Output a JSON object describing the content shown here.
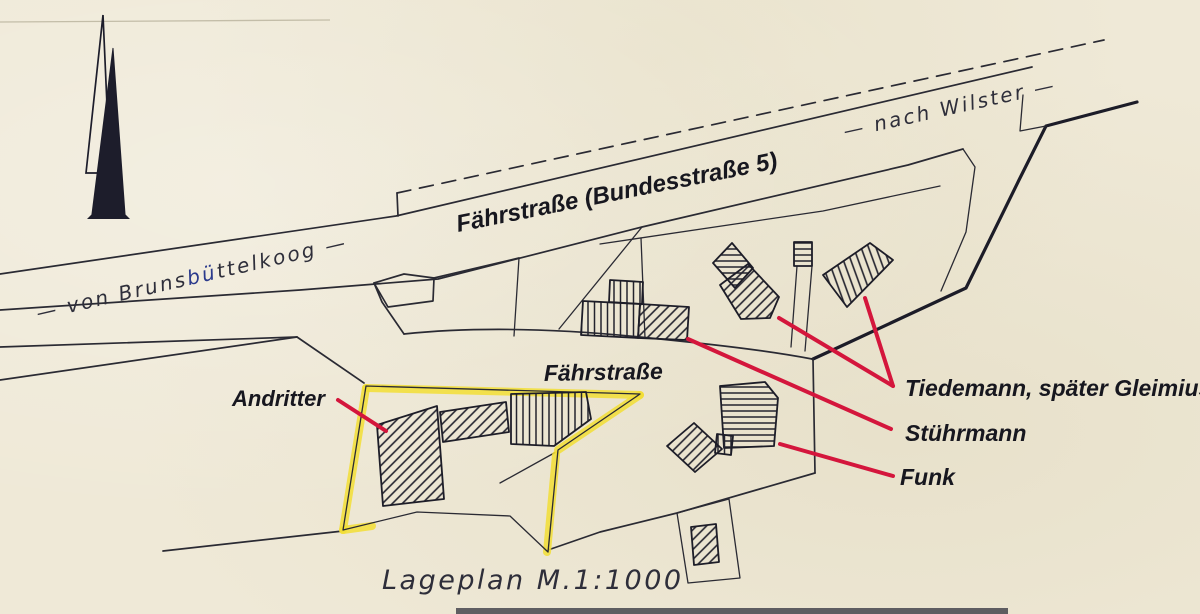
{
  "labels": {
    "road_b5": "Fährstraße (Bundesstraße 5)",
    "road_old": "Fährstraße",
    "direction_wilster": "— nach Wilster —",
    "direction_brunsbuettel_pre": "— von Bruns",
    "direction_brunsbuettel_fix": "bü",
    "direction_brunsbuettel_post": "ttelkoog —",
    "owner_andritter": "Andritter",
    "owner_tiedemann": "Tiedemann, später Gleimius",
    "owner_stuehrmann": "Stührmann",
    "owner_funk": "Funk",
    "caption": "Lageplan M.1:1000"
  },
  "colors": {
    "paper": "#efe9d7",
    "ink": "#2a2a33",
    "leader_red": "#d4163c",
    "highlight_yellow": "#f2de35",
    "correction_blue": "#2b3a8c"
  }
}
